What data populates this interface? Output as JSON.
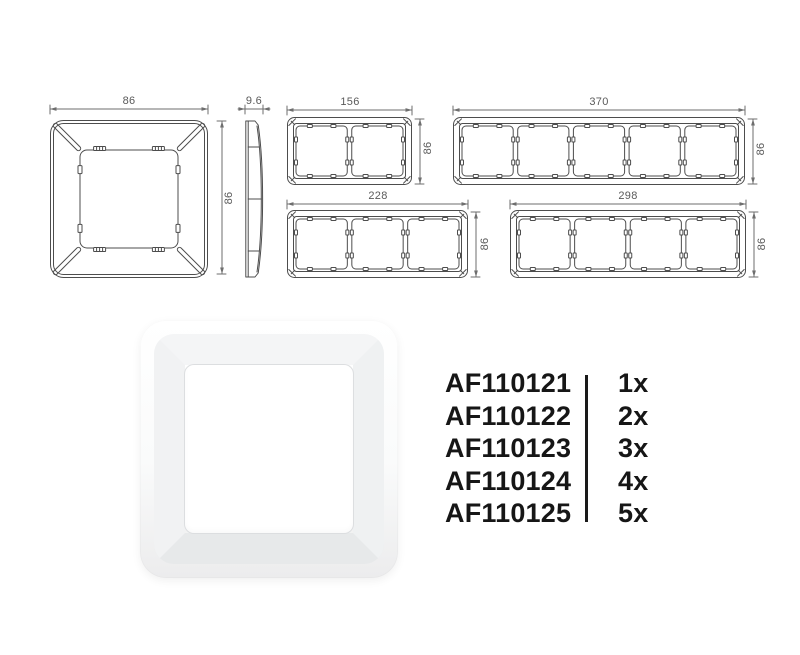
{
  "dimensions": {
    "single_width": "86",
    "single_height": "86",
    "side_thickness": "9.6",
    "gang2_width": "156",
    "gang2_height": "86",
    "gang3_width": "228",
    "gang3_height": "86",
    "gang4_width": "298",
    "gang4_height": "86",
    "gang5_width": "370",
    "gang5_height": "86"
  },
  "part_list": {
    "items": [
      {
        "code": "AF110121",
        "qty": "1x"
      },
      {
        "code": "AF110122",
        "qty": "2x"
      },
      {
        "code": "AF110123",
        "qty": "3x"
      },
      {
        "code": "AF110124",
        "qty": "4x"
      },
      {
        "code": "AF110125",
        "qty": "5x"
      }
    ]
  },
  "colors": {
    "line": "#4d4d4d",
    "dim": "#6e6e6e",
    "dim_text": "#5a5a5a",
    "list_text": "#161616",
    "divider": "#1a1a1a"
  }
}
